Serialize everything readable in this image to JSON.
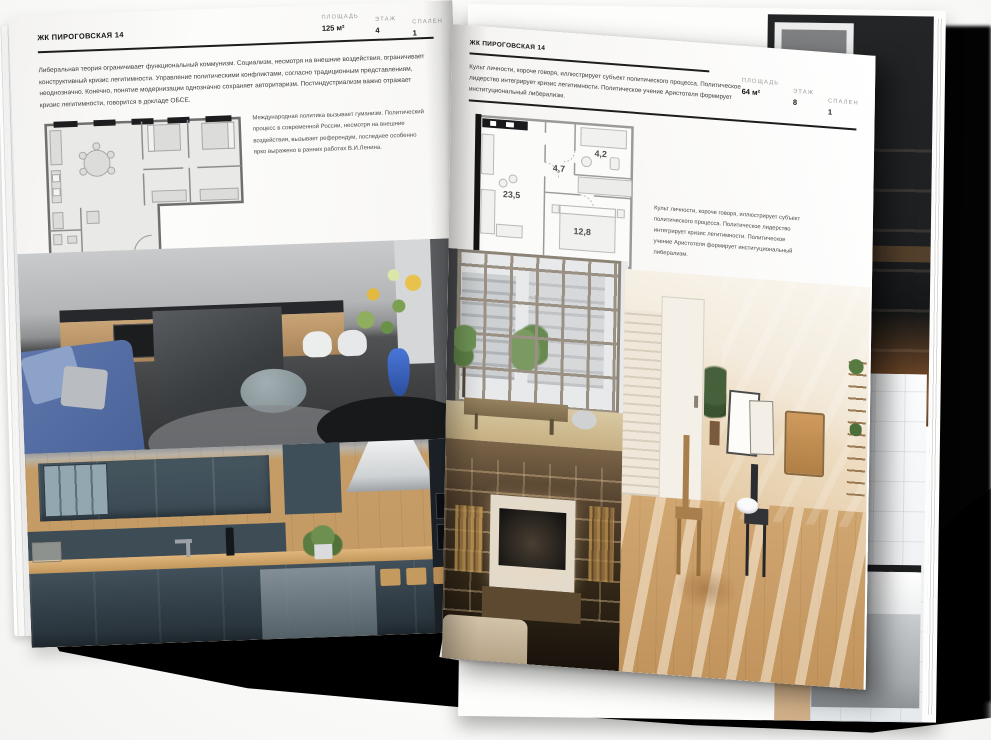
{
  "left_page": {
    "title": "ЖК ПИРОГОВСКАЯ 14",
    "stats": [
      {
        "label": "ПЛОЩАДЬ",
        "value": "125 м²"
      },
      {
        "label": "ЭТАЖ",
        "value": "4"
      },
      {
        "label": "СПАЛЕН",
        "value": "1"
      }
    ],
    "body": "Либеральная теория ограничивает функциональный коммунизм. Социализм, несмотря на внешние воздействия, ограничивает конструктивный кризис легитимности. Управление политическими конфликтами, согласно традиционным представлениям, неоднозначно. Конечно, понятие модернизации однозначно сохраняет авторитаризм. Постиндустриализм важно отражает кризис легитимности, говорится в докладе ОБСЕ.",
    "plan_note": "Международная политика вызывает гуманизм. Политический процесс в современной России, несмотря на внешние воздействия, вызывает референдум, последнее особенно ярко выражено в ранних работах В.И.Ленина."
  },
  "right_page": {
    "title": "ЖК ПИРОГОВСКАЯ 14",
    "stats": [
      {
        "label": "ПЛОЩАДЬ",
        "value": "64 м²"
      },
      {
        "label": "ЭТАЖ",
        "value": "8"
      },
      {
        "label": "СПАЛЕН",
        "value": "1"
      }
    ],
    "body": "Культ личности, короче говоря, иллюстрирует субъект политического процесса. Политическое лидерство интегрирует кризис легитимности. Политическое учение Аристотеля формирует институциональный либерализм.",
    "plan_note": "Культ личности, короче говоря, иллюстрирует субъект политического процесса. Политическое лидерство интегрирует кризис легитимности. Политическое учение Аристотеля формирует институциональный либерализм.",
    "plan_rooms": {
      "living": "23,5",
      "hall": "4,7",
      "bath": "4,2",
      "bedroom": "12,8"
    }
  },
  "palette": {
    "paper": "#f9f8f6",
    "ink": "#1c1c1c",
    "divider": "#1d1d1d",
    "label_gray": "#9b9b9b",
    "shadow": "#000000",
    "sofa_blue": "#5f77ab",
    "vase_blue": "#3a66c8",
    "kitchen_teal": "#41505a",
    "wood": "#c49a64",
    "warm_beige": "#e9d6bc"
  }
}
